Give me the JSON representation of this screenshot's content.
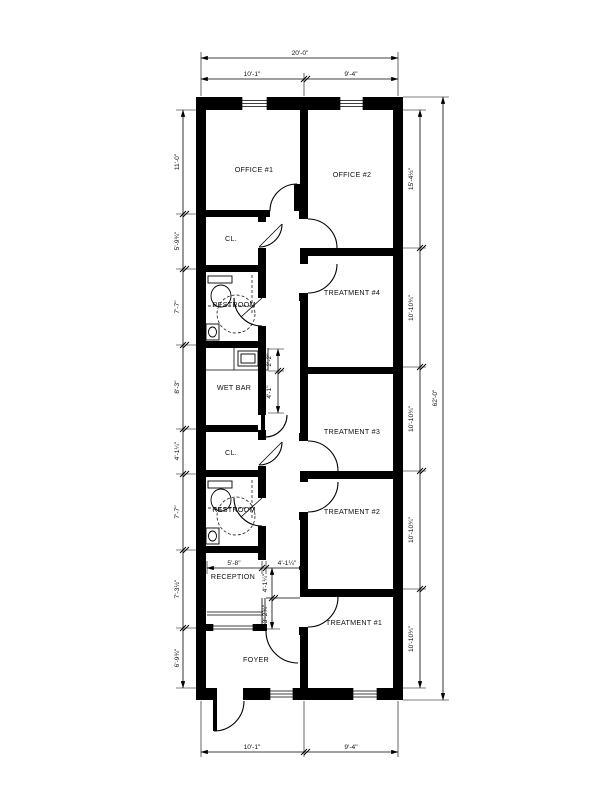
{
  "drawing": {
    "type": "architectural floor plan",
    "colors": {
      "line": "#000000",
      "paper": "#ffffff"
    },
    "rooms": [
      {
        "id": "office-1",
        "label": "OFFICE #1"
      },
      {
        "id": "office-2",
        "label": "OFFICE #2"
      },
      {
        "id": "closet-upper",
        "label": "CL."
      },
      {
        "id": "restroom-upper",
        "label": "RESTROOM"
      },
      {
        "id": "treatment-4",
        "label": "TREATMENT #4"
      },
      {
        "id": "wet-bar",
        "label": "WET BAR"
      },
      {
        "id": "treatment-3",
        "label": "TREATMENT #3"
      },
      {
        "id": "closet-lower",
        "label": "CL."
      },
      {
        "id": "restroom-lower",
        "label": "RESTROOM"
      },
      {
        "id": "treatment-2",
        "label": "TREATMENT #2"
      },
      {
        "id": "reception",
        "label": "RECEPTION"
      },
      {
        "id": "treatment-1",
        "label": "TREATMENT #1"
      },
      {
        "id": "foyer",
        "label": "FOYER"
      }
    ],
    "dimensions": {
      "top_overall": "20'-0\"",
      "top_left": "10'-1\"",
      "top_right": "9'-4\"",
      "bottom_left": "10'-1\"",
      "bottom_right": "9'-4\"",
      "left_side": [
        "11'-0\"",
        "5'-9¾\"",
        "7'-7\"",
        "8'-3\"",
        "4'-1¼\"",
        "7'-7\"",
        "7'-3½\"",
        "6'-9¾\""
      ],
      "right_side": [
        "15'-4½\"",
        "10'-10¾\"",
        "10'-10¾\"",
        "10'-10¾\"",
        "10'-10¾\""
      ],
      "right_overall": "62'-0\"",
      "wet_bar_counter": "2'-2\"",
      "wet_bar_depth": "4'-1\"",
      "reception_width": "5'-8\"",
      "vestibule_width": "4'-1¼\"",
      "vestibule_upper": "4'-1¼\"",
      "vestibule_lower": "3'-2¾\""
    }
  }
}
